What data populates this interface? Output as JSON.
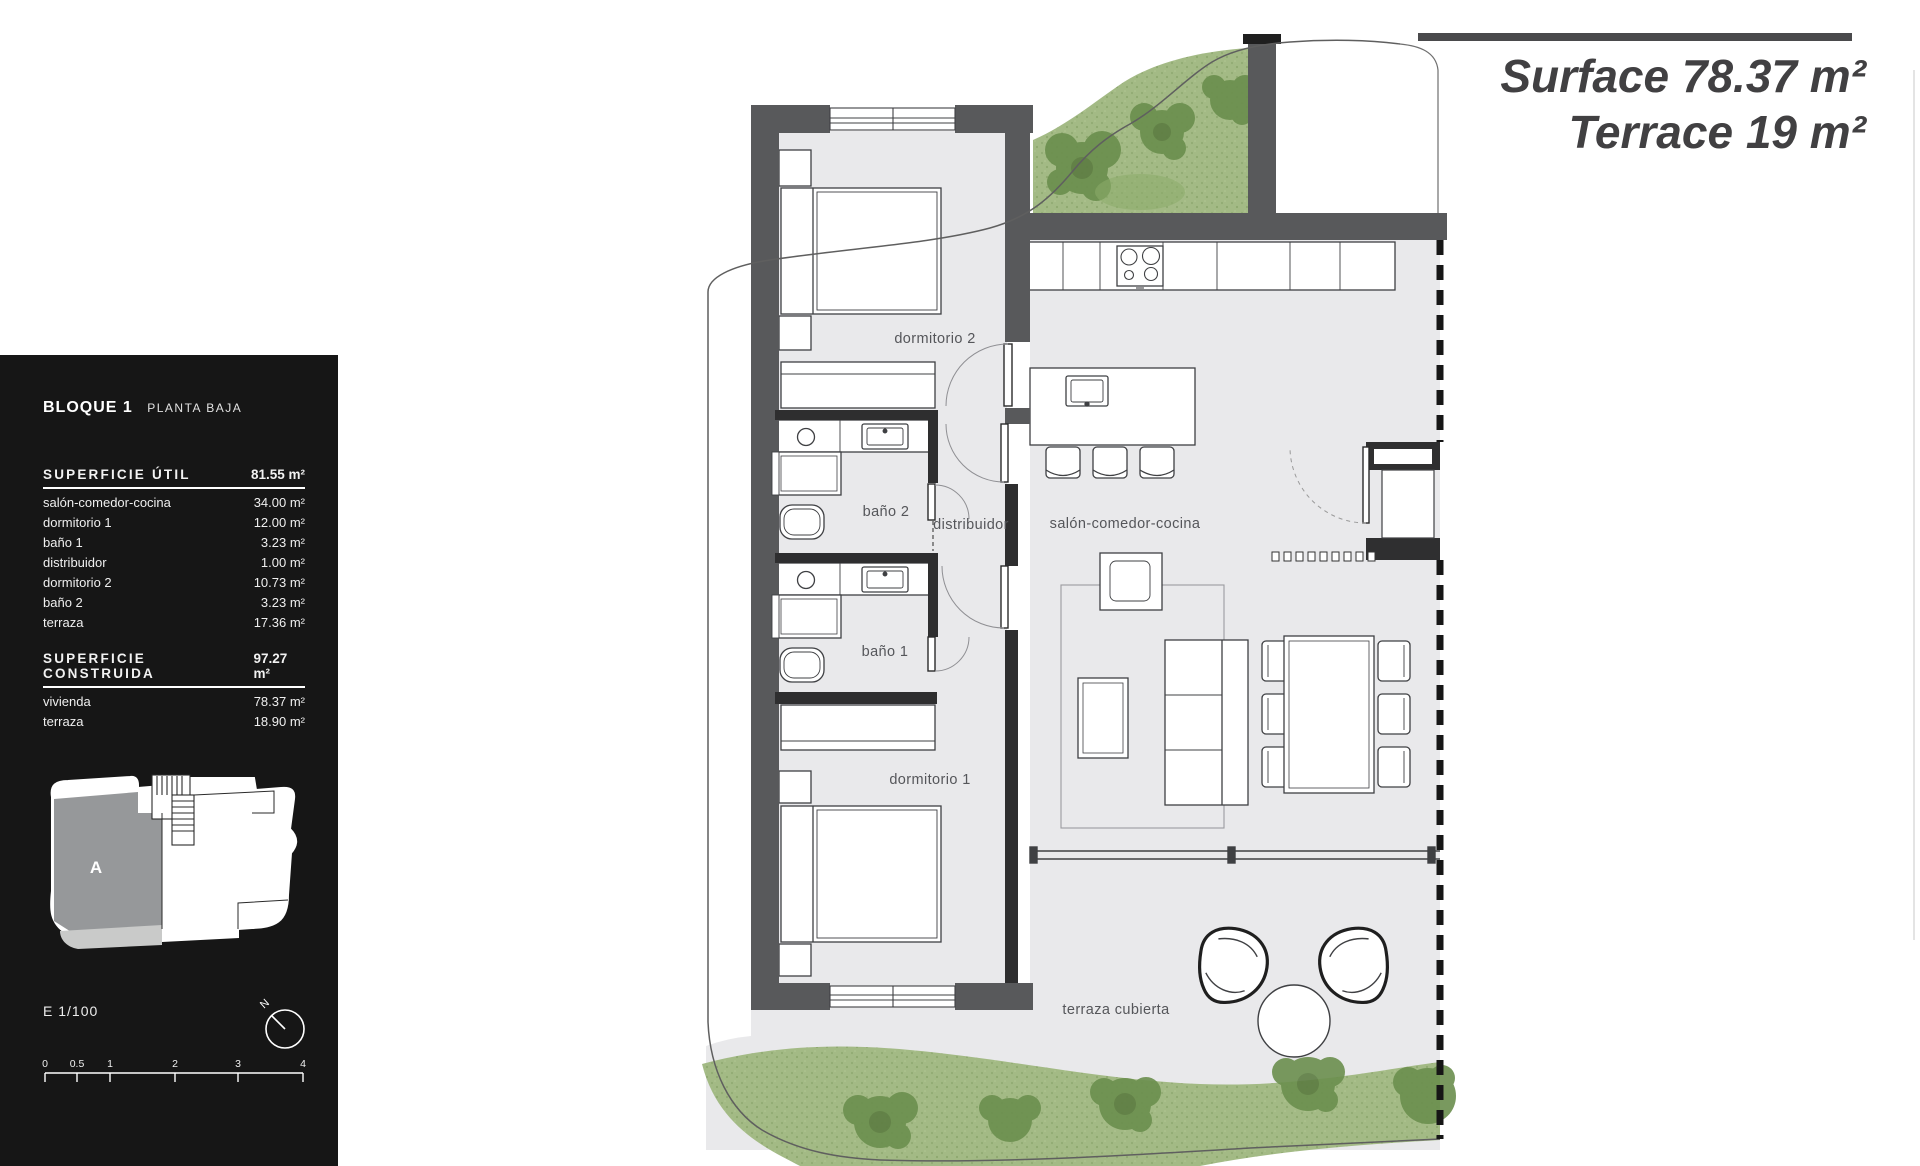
{
  "sidebar": {
    "block": {
      "title": "BLOQUE 1",
      "subtitle": "PLANTA BAJA"
    },
    "useful_area": {
      "header": "SUPERFICIE ÚTIL",
      "total": "81.55 m²",
      "rows": [
        {
          "label": "salón-comedor-cocina",
          "value": "34.00 m²"
        },
        {
          "label": "dormitorio 1",
          "value": "12.00 m²"
        },
        {
          "label": "baño 1",
          "value": "3.23 m²"
        },
        {
          "label": "distribuidor",
          "value": "1.00 m²"
        },
        {
          "label": "dormitorio 2",
          "value": "10.73 m²"
        },
        {
          "label": "baño 2",
          "value": "3.23 m²"
        },
        {
          "label": "terraza",
          "value": "17.36 m²"
        }
      ]
    },
    "built_area": {
      "header": "SUPERFICIE CONSTRUIDA",
      "total": "97.27 m²",
      "rows": [
        {
          "label": "vivienda",
          "value": "78.37 m²"
        },
        {
          "label": "terraza",
          "value": "18.90 m²"
        }
      ]
    },
    "key_plan": {
      "unit_label": "A"
    },
    "scale_text": "E 1/100",
    "compass": {
      "north_label": "N"
    },
    "scale_bar": {
      "ticks": [
        "0",
        "0.5",
        "1",
        "2",
        "3",
        "4"
      ]
    }
  },
  "title_block": {
    "line1_label": "Surface",
    "line1_value": "78.37 m²",
    "line2_label": "Terrace",
    "line2_value": "19 m²"
  },
  "plan": {
    "room_labels": {
      "dormitorio2": "dormitorio 2",
      "bano2": "baño 2",
      "distribuidor": "distribuidor",
      "salon": "salón-comedor-cocina",
      "bano1": "baño 1",
      "dormitorio1": "dormitorio 1",
      "terraza": "terraza cubierta"
    }
  },
  "colors": {
    "wall": "#58595b",
    "wall_dark": "#2e2e2f",
    "floor": "#e9e9eb",
    "grass": "#a3ba85",
    "tree": "#6b8f4e",
    "sidebar_bg": "#161616",
    "title_text": "#414042"
  }
}
